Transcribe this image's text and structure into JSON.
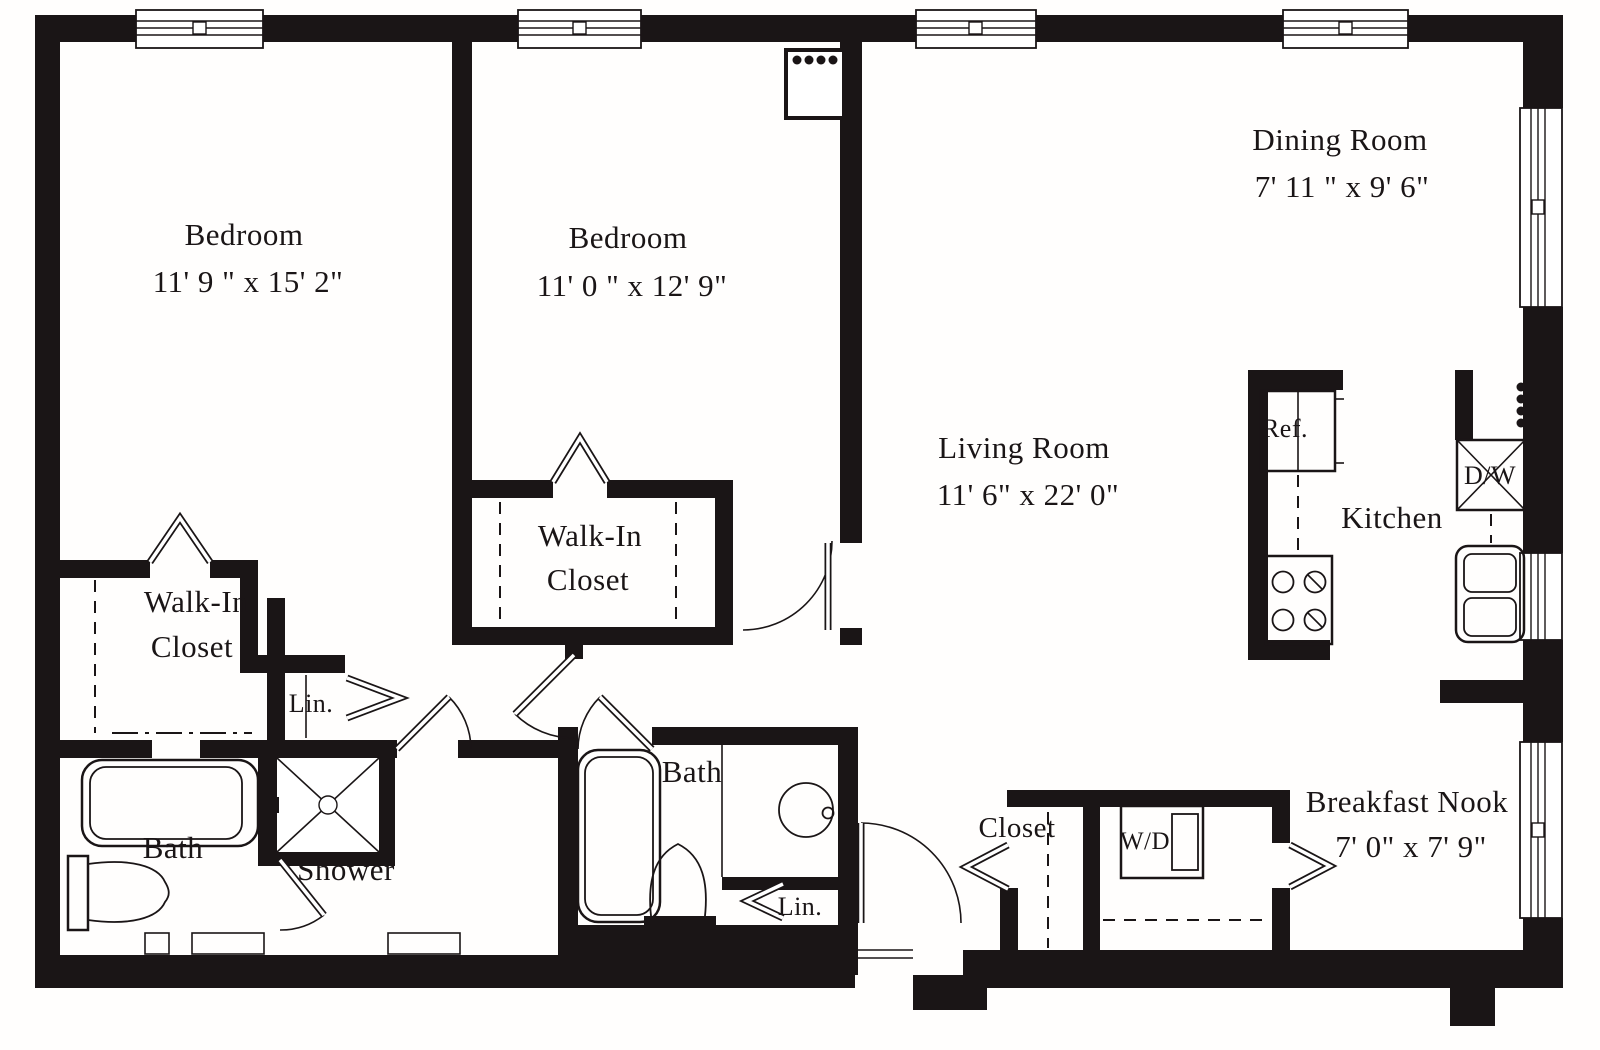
{
  "plan": {
    "title": "Two-bedroom apartment floor plan",
    "colors": {
      "ink": "#1a1516",
      "paper": "#ffffff"
    },
    "rooms": {
      "bedroom1": {
        "name": "Bedroom",
        "dims": "11' 9 \" x 15' 2\""
      },
      "bedroom2": {
        "name": "Bedroom",
        "dims": "11' 0 \" x 12' 9\""
      },
      "dining": {
        "name": "Dining Room",
        "dims": "7' 11 \" x 9' 6\""
      },
      "living": {
        "name": "Living Room",
        "dims": "11' 6\" x 22' 0\""
      },
      "nook": {
        "name": "Breakfast Nook",
        "dims": "7' 0\" x 7' 9\""
      },
      "kitchen": {
        "name": "Kitchen"
      },
      "wic1": {
        "line1": "Walk-In",
        "line2": "Closet"
      },
      "wic2": {
        "line1": "Walk-In",
        "line2": "Closet"
      },
      "bath1": {
        "name": "Bath"
      },
      "bath2": {
        "name": "Bath"
      },
      "shower": {
        "name": "Shower"
      },
      "lin1": {
        "name": "Lin."
      },
      "lin2": {
        "name": "Lin."
      },
      "closet": {
        "name": "Closet"
      }
    },
    "appliances": {
      "ref": "Ref.",
      "dw": "D/W",
      "wd": "W/D"
    }
  }
}
